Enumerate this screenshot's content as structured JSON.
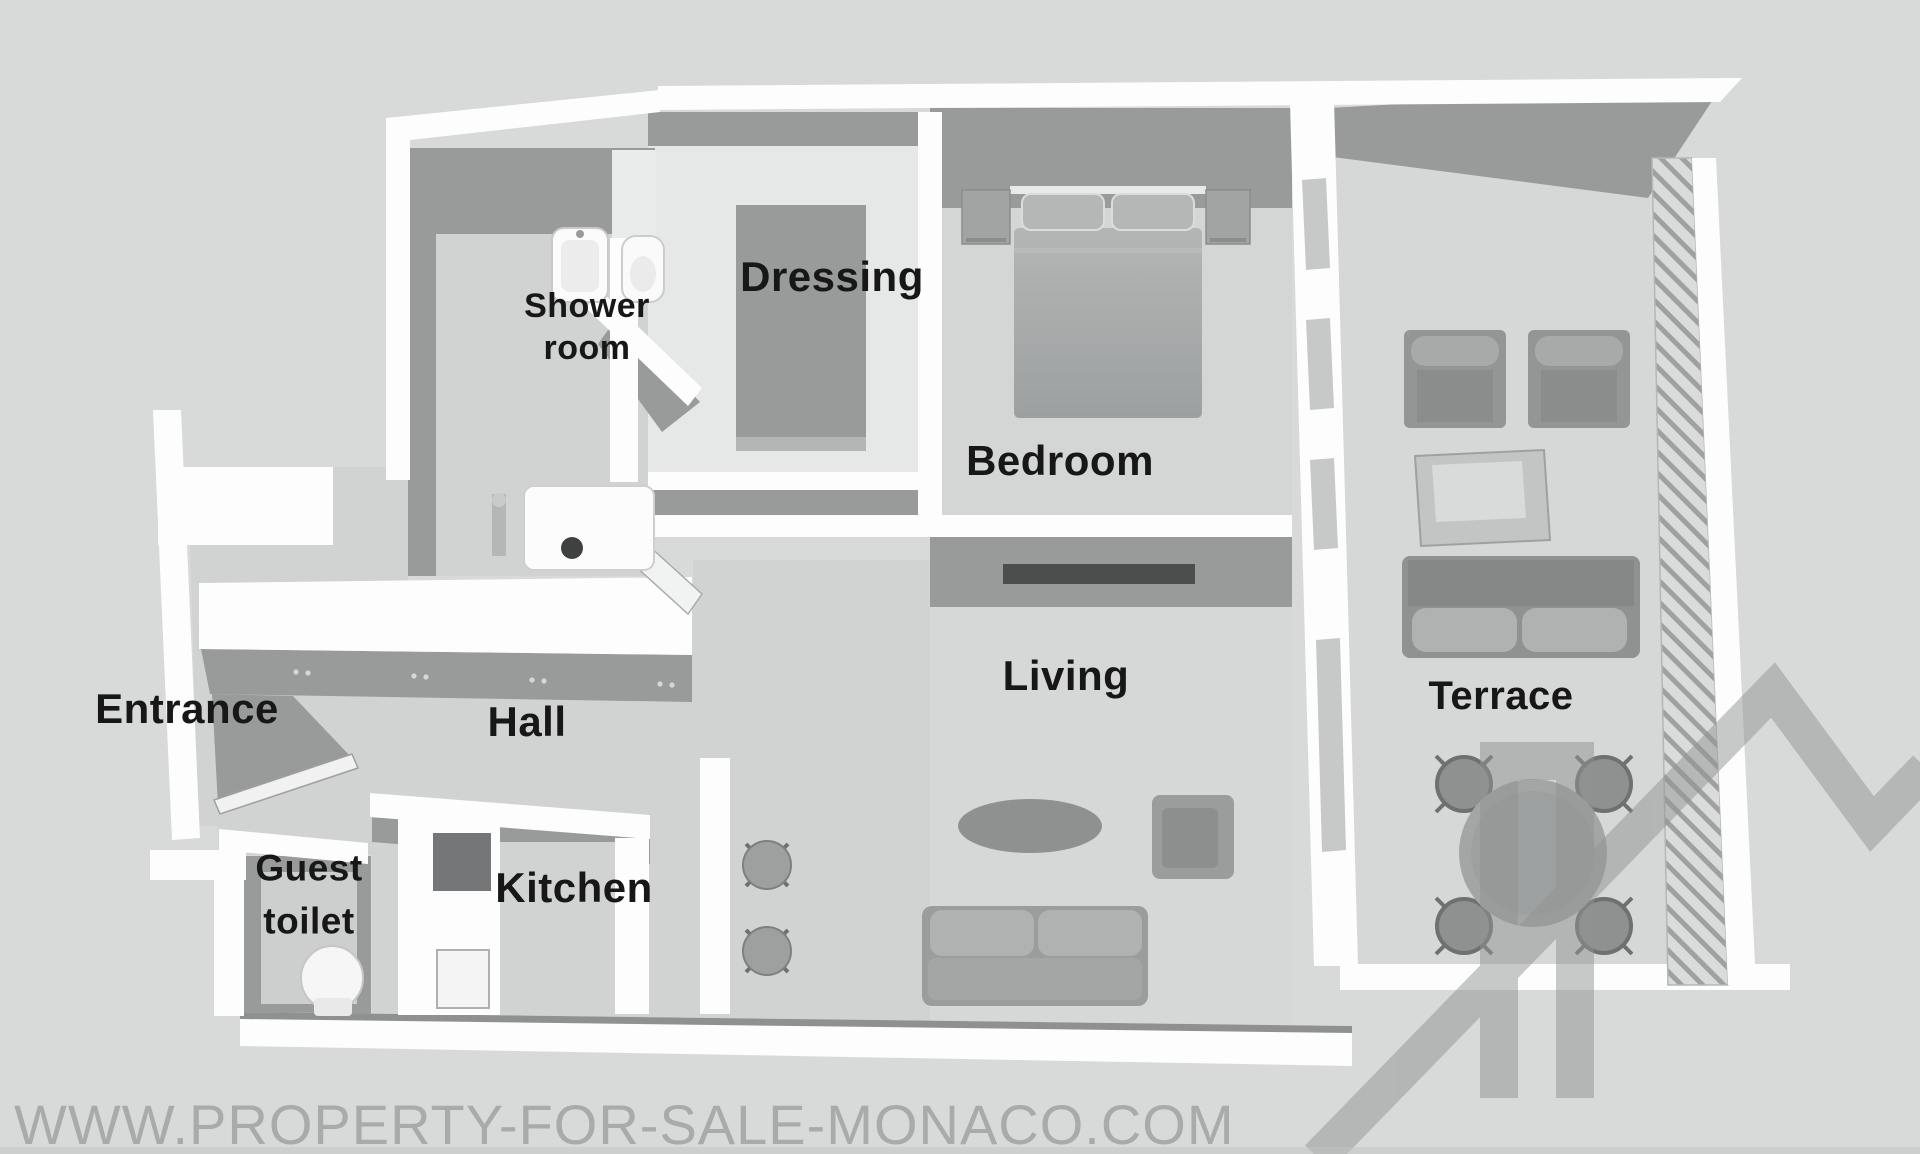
{
  "page": {
    "type": "3d-floor-plan-render",
    "view": "top-down-3d-apartment"
  },
  "rooms": {
    "entrance": {
      "label": "Entrance"
    },
    "hall": {
      "label": "Hall"
    },
    "guest_toilet": {
      "label": "Guest toilet"
    },
    "kitchen": {
      "label": "Kitchen"
    },
    "shower_room": {
      "label": "Shower room"
    },
    "dressing": {
      "label": "Dressing"
    },
    "bedroom": {
      "label": "Bedroom"
    },
    "living": {
      "label": "Living"
    },
    "terrace": {
      "label": "Terrace"
    }
  },
  "watermark": {
    "site_url": "WWW.PROPERTY-FOR-SALE-MONACO.COM",
    "logo": "house-outline-logo"
  },
  "colors": {
    "bg": "#d8d9d9",
    "floor": "#d1d2d2",
    "floor-light": "#e6e7e7",
    "wall-dark": "#999b9b",
    "wall-white": "#fdfdfd",
    "furniture": "#a2a4a4",
    "furniture-dark": "#8c8e8e",
    "console": "#4c4e4e",
    "label": "#171717",
    "watermark": "#a9aaaa",
    "logo": "#929494"
  }
}
